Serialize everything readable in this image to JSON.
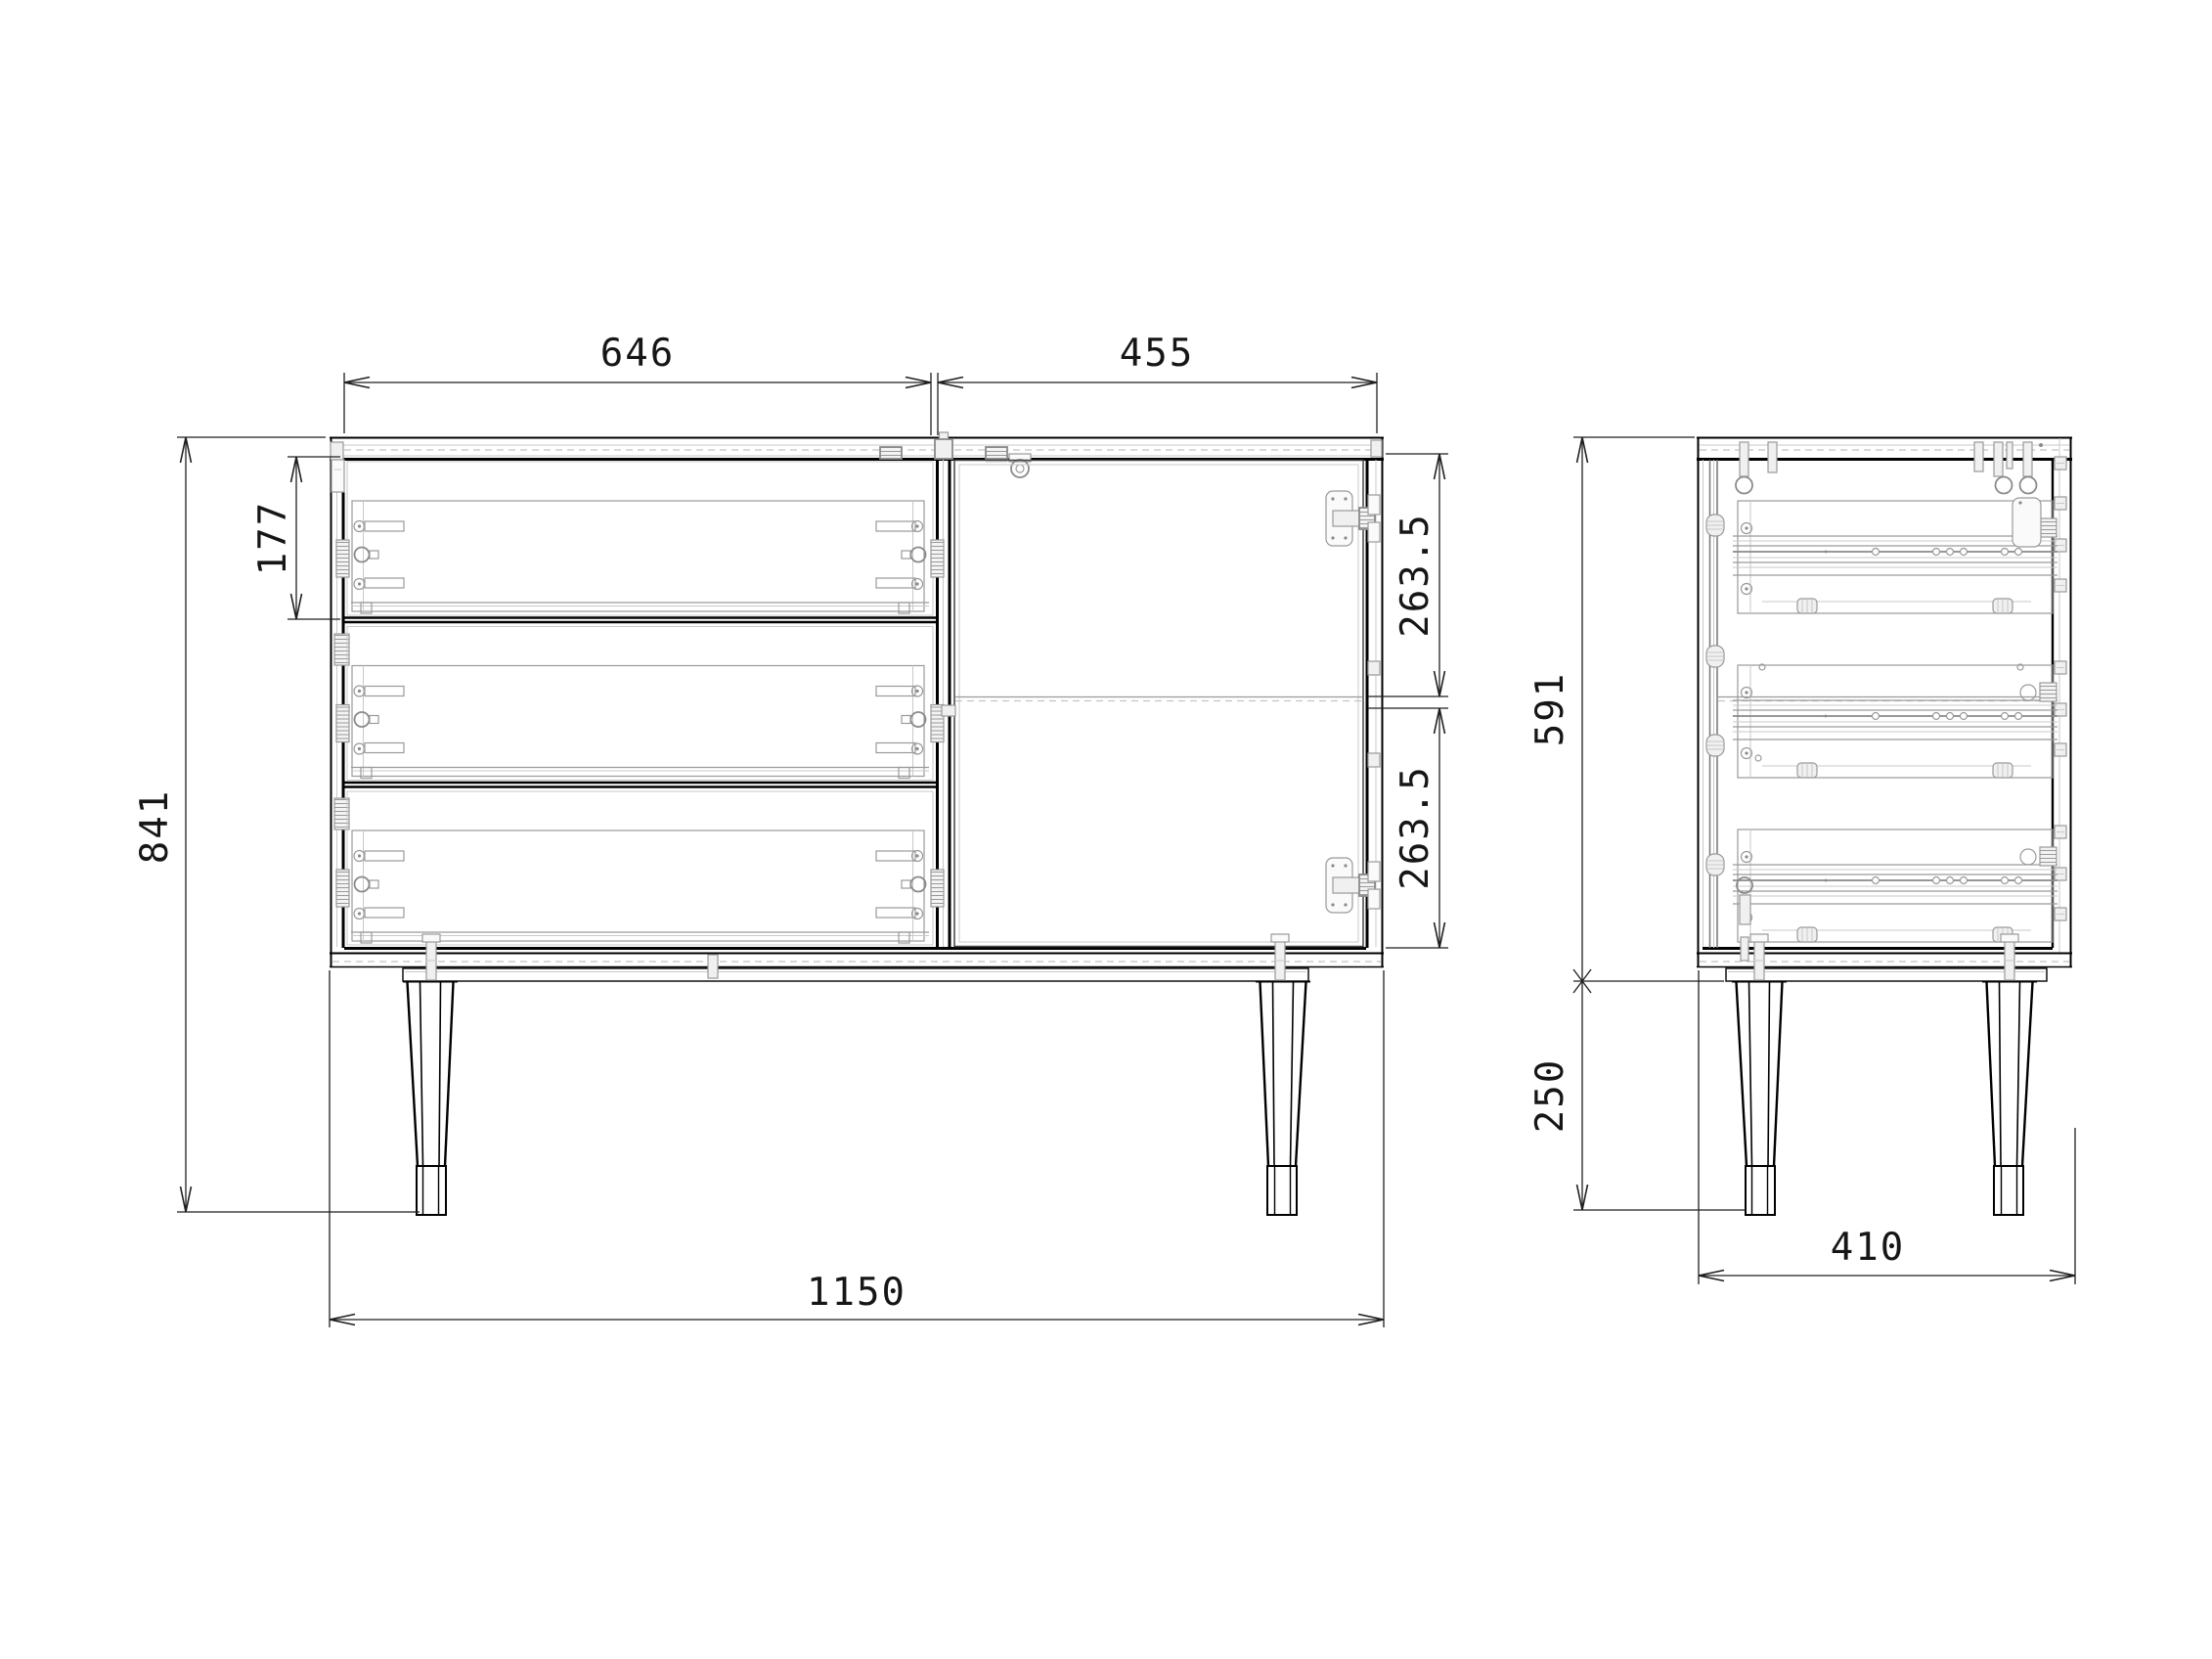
{
  "page": {
    "background": "#ffffff"
  },
  "drawing": {
    "stroke_main": "#000000",
    "stroke_hardware": "#9a9a9a",
    "stroke_dimension": "#1f1f1f"
  },
  "dimensions": {
    "front_view": {
      "drawer_opening_width": "646",
      "door_opening_width": "455",
      "top_drawer_front_height": "177",
      "overall_height": "841",
      "door_upper_section": "263.5",
      "door_lower_section": "263.5",
      "overall_width": "1150"
    },
    "side_view": {
      "carcass_height": "591",
      "leg_height": "250",
      "overall_depth": "410"
    }
  }
}
